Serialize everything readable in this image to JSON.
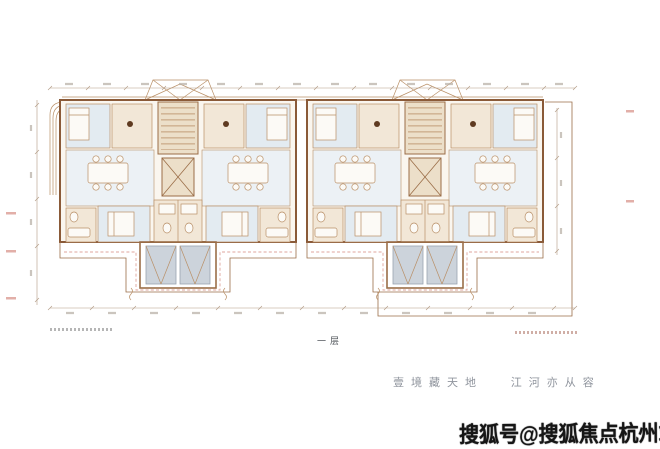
{
  "colors": {
    "plan_line": "#9b6e48",
    "plan_line_light": "#b98f66",
    "wall_dark": "#8a5a38",
    "room_blue": "#e3ebf1",
    "room_tan": "#f2e7d7",
    "living_tint": "#ecf1f5",
    "core_tan": "#ecdfc9",
    "bed_gray": "#ccd3db",
    "terrace_dash": "#dfa49c",
    "dim_line": "#b19a83",
    "margin_mark": "#e2afa8",
    "tagline_gray": "#8f949d",
    "floor_label_gray": "#4f545a",
    "watermark_ink": "#161616",
    "background": "#ffffff"
  },
  "plan": {
    "floor_label": "一层"
  },
  "tagline": {
    "phrase1": "壹境藏天地",
    "phrase2": "江河亦从容"
  },
  "watermark": {
    "text": "搜狐号@搜狐焦点杭州站"
  }
}
